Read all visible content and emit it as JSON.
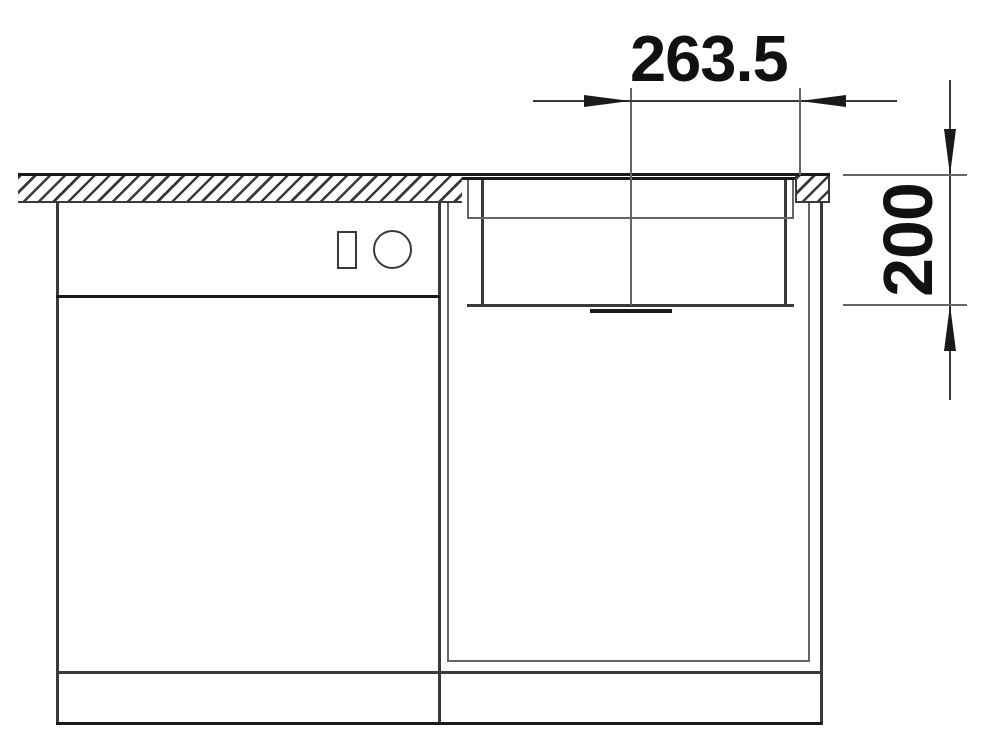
{
  "drawing": {
    "type": "technical-installation-drawing",
    "subject": "undermount-sink-in-countertop-front-section",
    "dimensions": {
      "horizontal": {
        "value": "263.5",
        "meaning": "distance from bowl centerline to countertop edge"
      },
      "vertical": {
        "value": "200",
        "meaning": "bowl depth below worktop surface"
      }
    },
    "colors": {
      "line_dark": "#1a1a1a",
      "line_mid": "#3a3a3a",
      "line_light": "#666666",
      "background": "#ffffff",
      "text": "#111111"
    }
  }
}
